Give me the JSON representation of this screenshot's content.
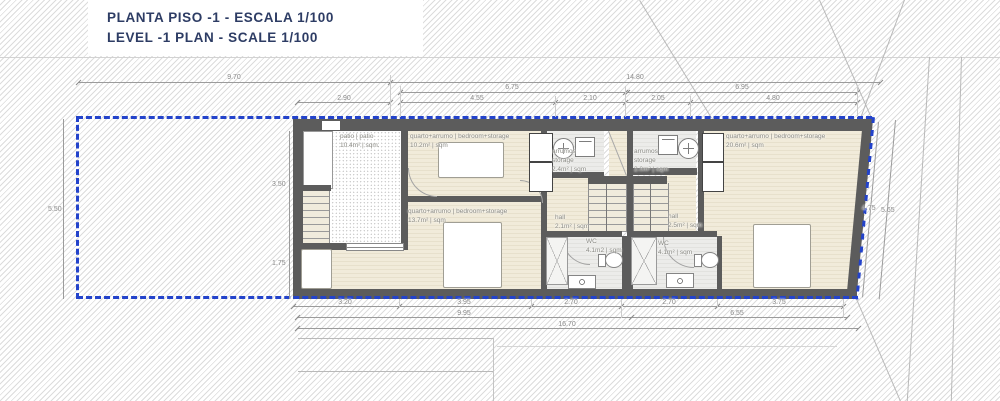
{
  "title": {
    "line1": "PLANTA PISO -1 - ESCALA 1/100",
    "line2": "LEVEL -1 PLAN - SCALE 1/100"
  },
  "colors": {
    "property_line_blue": "#2343cb",
    "title_navy": "#2d3c64",
    "wall_gray": "#5c5c5c",
    "floor_cream": "#f1ebda"
  },
  "rooms": [
    {
      "id": "patio",
      "name": "patio | patio",
      "area": "10.4m² | sqm."
    },
    {
      "id": "bedroom-storage-1",
      "name": "quarto+arrumo | bedroom+storage",
      "area": "10.2m² | sqm"
    },
    {
      "id": "storage-1",
      "name": "arrumos",
      "name2": "storage",
      "area": "2.4m² | sqm"
    },
    {
      "id": "storage-2",
      "name": "arrumos",
      "name2": "storage",
      "area": "2.0m² | sqm"
    },
    {
      "id": "bedroom-storage-2",
      "name": "quarto+arrumo | bedroom+storage",
      "area": "13.7m² | sqm"
    },
    {
      "id": "hall-1",
      "name": "hall",
      "area": "2.1m² | sqm"
    },
    {
      "id": "hall-2",
      "name": "hall",
      "area": "2.5m² | sqm"
    },
    {
      "id": "wc-1",
      "name": "WC",
      "area": "4.1m2 | sqm"
    },
    {
      "id": "wc-2",
      "name": "WC",
      "area": "4.1m² | sqm"
    },
    {
      "id": "bedroom-storage-3",
      "name": "quarto+arrumo | bedroom+storage",
      "area": "20.6m² | sqm"
    }
  ],
  "dimensions": {
    "top": [
      "9.70",
      "14.80",
      "6.75",
      "6.95",
      "2.90",
      "4.55",
      "2.10",
      "2.05",
      "4.80"
    ],
    "bottom": [
      "3.20",
      "3.95",
      "2.70",
      "2.70",
      "3.75",
      "9.95",
      "6.55",
      "16.70"
    ],
    "left": [
      "5.50",
      "3.50",
      "1.75"
    ],
    "right": [
      "4.75",
      "5.65"
    ]
  }
}
